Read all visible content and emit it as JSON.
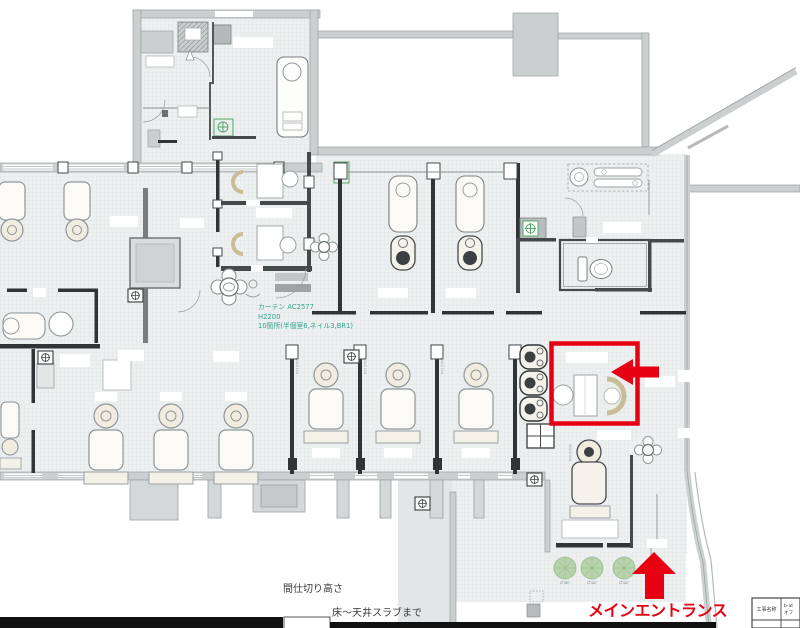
{
  "plan": {
    "curtain_note": {
      "line1": "カーテン AC2577",
      "line2": "H2200",
      "line3": "10箇所(半個室6,ネイル3,BR1)"
    },
    "wagon_label": "WAGON",
    "plant_label": "chair"
  },
  "annotations": {
    "entrance_label": "メインエントランス"
  },
  "partition_note": {
    "heading": "間仕切り高さ",
    "line1": "床～天井スラブまで",
    "line2": "(CH2,950)(ENTのみCH2,300)"
  },
  "title_block": {
    "label": "工事名称",
    "value_line1": "b-at",
    "value_line2": "オフ"
  },
  "colors": {
    "accent_red": "#E60012",
    "note_teal": "#2FA38C",
    "wall_gray": "#CBCFD0",
    "plant_green": "#B7D3AB"
  }
}
